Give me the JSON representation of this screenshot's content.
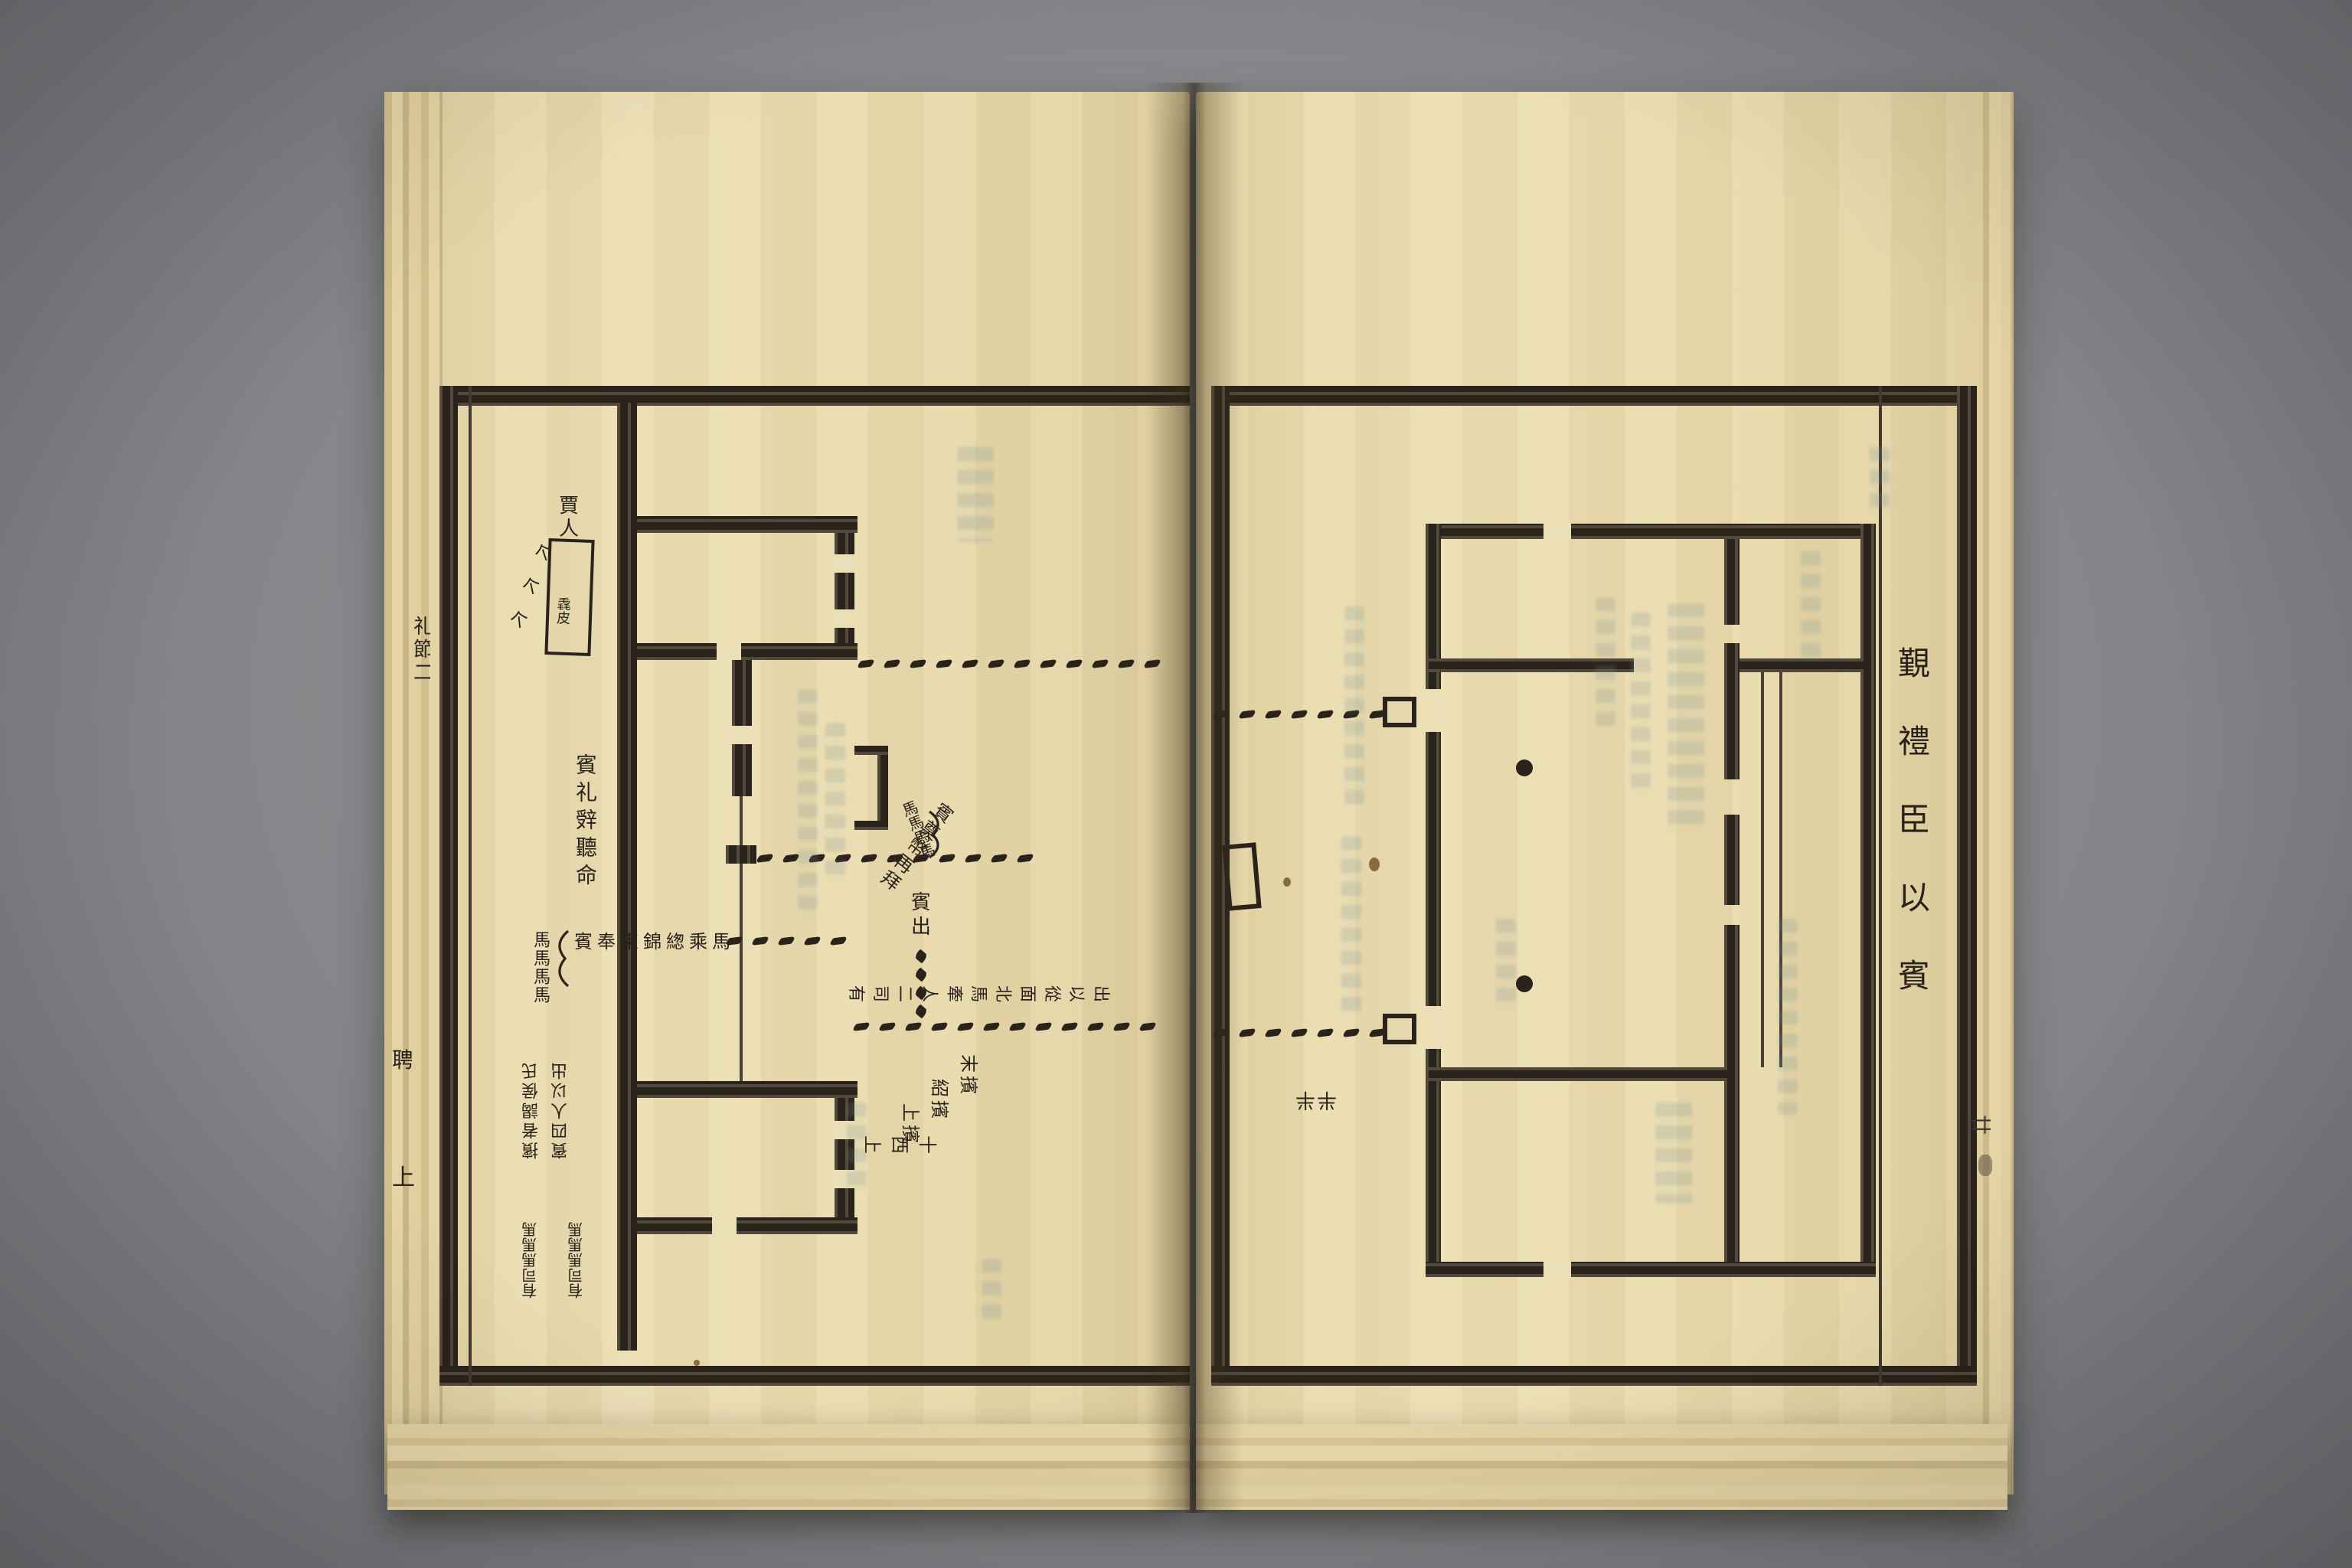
{
  "ink_color": "#29221a",
  "paper_color": "#eadfb6",
  "background_color": "#85878a",
  "left_page": {
    "edge_text": {
      "column": "礼節二",
      "partial_a": "聘",
      "partial_b": "上"
    },
    "labels": {
      "merchant": "賈人",
      "jie_marks": [
        "个",
        "个",
        "个"
      ],
      "box": "毳皮",
      "guest_declines": "賓礼辤聽命",
      "horses_a": "馬馬馬馬",
      "offering": "賓奉束錦緫乘馬",
      "horses_b": "馬馬馬馬",
      "gift": "賓奠幣再拜",
      "guest_exit": "賓出",
      "officials": "有司二人牽馬北面從以出",
      "usher_top": "末擯",
      "usher_mid": "紹擯",
      "usher_bottom": "上擯",
      "west_upper": "十西上",
      "flipped_a": "擯者謁侯氏",
      "flipped_b": "賓四人以出",
      "flipped_horses_a": "有司馬馬馬",
      "flipped_horses_b": "有司馬馬馬"
    }
  },
  "right_page": {
    "title": "覲禮臣以賓",
    "leaf_number": "廿",
    "rotated_mark": "半半"
  }
}
